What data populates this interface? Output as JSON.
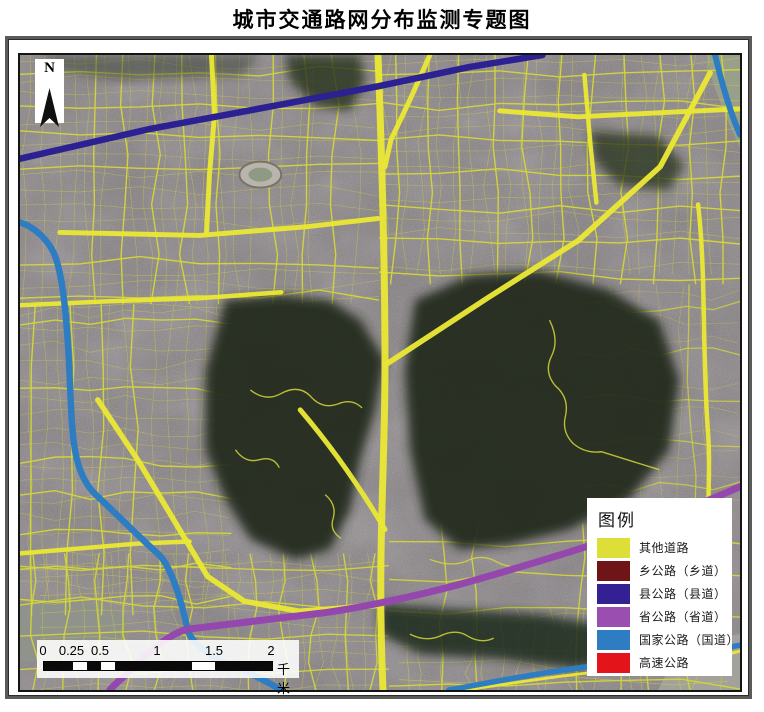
{
  "title": "城市交通路网分布监测专题图",
  "north_arrow": {
    "label": "N"
  },
  "legend": {
    "title": "图例",
    "items": [
      {
        "label": "其他道路",
        "color": "#dede39"
      },
      {
        "label": "乡公路（乡道）",
        "color": "#6f1518"
      },
      {
        "label": "县公路（县道）",
        "color": "#332193"
      },
      {
        "label": "省公路（省道）",
        "color": "#9a4fb0"
      },
      {
        "label": "国家公路（国道）",
        "color": "#2e7dc3"
      },
      {
        "label": "高速公路",
        "color": "#e3151b"
      }
    ]
  },
  "scale_bar": {
    "unit": "千米",
    "ticks": [
      {
        "f": 0,
        "t": "0"
      },
      {
        "f": 0.125,
        "t": "0.25"
      },
      {
        "f": 0.25,
        "t": "0.5"
      },
      {
        "f": 0.5,
        "t": "1"
      },
      {
        "f": 0.75,
        "t": "1.5"
      },
      {
        "f": 1,
        "t": "2"
      }
    ],
    "segments": [
      {
        "f": 0.125,
        "c": "#0a0a0a"
      },
      {
        "f": 0.0625,
        "c": "#ffffff"
      },
      {
        "f": 0.0625,
        "c": "#0a0a0a"
      },
      {
        "f": 0.0625,
        "c": "#ffffff"
      },
      {
        "f": 0.3375,
        "c": "#0a0a0a"
      },
      {
        "f": 0.1,
        "c": "#ffffff"
      },
      {
        "f": 0.25,
        "c": "#0a0a0a"
      }
    ]
  },
  "map": {
    "colors": {
      "base": "#85807d",
      "tint": "#776b85",
      "other_road": "#e9e636",
      "minor_road": "#d4d737",
      "township": "#6f1518",
      "county": "#2c2192",
      "provincial": "#9448ad",
      "national": "#2e7dc3",
      "expressway": "#e3151b"
    },
    "water": [
      {
        "fill": "#90938c",
        "d": "M0,548 L45,543 L85,551 L105,561 L111,580 L98,598 L58,601 L18,609 L0,607 Z"
      },
      {
        "fill": "#a2a19b",
        "d": "M640,637 L658,601 L688,586 L722,581 L722,637 Z"
      },
      {
        "fill": "#99a089",
        "d": "M688,0 L722,0 L722,93 L706,58 L693,22 Z"
      }
    ],
    "grid_zones": [
      {
        "x": 0,
        "y": 0,
        "w": 360,
        "h": 250,
        "sx": 30,
        "sy": 32,
        "seed": 7,
        "width": 1.4,
        "op": 0.95
      },
      {
        "x": 360,
        "y": 0,
        "w": 362,
        "h": 230,
        "sx": 33,
        "sy": 34,
        "seed": 11,
        "width": 1.4,
        "op": 0.95
      },
      {
        "x": 0,
        "y": 250,
        "w": 212,
        "h": 312,
        "sx": 33,
        "sy": 35,
        "seed": 13,
        "width": 1.4,
        "op": 0.95
      },
      {
        "x": 0,
        "y": 500,
        "w": 370,
        "h": 137,
        "sx": 31,
        "sy": 33,
        "seed": 17,
        "width": 1.4,
        "op": 0.9
      },
      {
        "x": 370,
        "y": 470,
        "w": 352,
        "h": 167,
        "sx": 35,
        "sy": 36,
        "seed": 19,
        "width": 1.4,
        "op": 0.9
      },
      {
        "x": 560,
        "y": 230,
        "w": 162,
        "h": 240,
        "sx": 45,
        "sy": 45,
        "seed": 23,
        "width": 1.3,
        "op": 0.75
      },
      {
        "x": 0,
        "y": 0,
        "w": 360,
        "h": 250,
        "sx": 15,
        "sy": 16,
        "seed": 31,
        "width": 0.6,
        "op": 0.5
      },
      {
        "x": 360,
        "y": 0,
        "w": 362,
        "h": 220,
        "sx": 17,
        "sy": 17,
        "seed": 37,
        "width": 0.6,
        "op": 0.5
      },
      {
        "x": 0,
        "y": 250,
        "w": 210,
        "h": 300,
        "sx": 16,
        "sy": 17,
        "seed": 41,
        "width": 0.6,
        "op": 0.5
      },
      {
        "x": 20,
        "y": 500,
        "w": 340,
        "h": 137,
        "sx": 16,
        "sy": 16,
        "seed": 43,
        "width": 0.6,
        "op": 0.5
      },
      {
        "x": 380,
        "y": 555,
        "w": 330,
        "h": 82,
        "sx": 16,
        "sy": 16,
        "seed": 47,
        "width": 0.7,
        "op": 0.55
      },
      {
        "x": 560,
        "y": 230,
        "w": 160,
        "h": 230,
        "sx": 23,
        "sy": 23,
        "seed": 53,
        "width": 0.6,
        "op": 0.4
      }
    ],
    "hills": [
      {
        "fill": "#222c1e",
        "op": 0.93,
        "d": "M206,246 L261,241 L311,246 L341,266 L366,306 L356,356 L341,406 L331,456 L311,496 L276,506 L231,486 L206,446 L186,396 L186,316 Z"
      },
      {
        "fill": "#202a1d",
        "op": 0.93,
        "d": "M396,246 L451,221 L521,216 L591,236 L641,266 L661,326 L651,396 L611,446 L551,476 L491,491 L441,496 L406,466 L391,396 L386,316 Z"
      },
      {
        "fill": "#26301f",
        "op": 0.8,
        "d": "M266,0 L341,0 L346,26 L331,56 L296,51 L271,26 Z"
      },
      {
        "fill": "#26301f",
        "op": 0.75,
        "d": "M571,76 L641,81 L666,111 L651,136 L601,131 L576,106 Z"
      },
      {
        "fill": "#1f2a1c",
        "op": 0.85,
        "d": "M361,551 L441,556 L521,561 L581,571 L601,601 L561,616 L481,606 L401,601 L361,581 Z"
      },
      {
        "fill": "#2b3425",
        "op": 0.45,
        "d": "M21,0 L241,0 L221,21 L101,26 L41,16 Z"
      }
    ],
    "hill_paths": [
      "M231,336 q15,12 30,4 q18,-10 30,2 q12,14 28,8 q14,-6 24,4",
      "M531,266 q10,20 2,36 q-8,16 4,30 q14,12 10,30 q-4,16 8,28 q12,10 28,8 L641,416",
      "M411,506 q20,8 36,2 q16,-8 30,0 q14,8 30,4",
      "M306,441 q12,10 8,24 q-4,12 8,20",
      "M391,581 q16,8 30,2 q16,-8 28,0 q14,8 26,2",
      "M216,396 q10,14 24,10 q14,-4 20,8"
    ],
    "stadium": {
      "cx": 241,
      "cy": 120,
      "rx": 21,
      "ry": 13
    },
    "arteries": [
      {
        "w": 7,
        "d": "M359,0 C362,80 366,200 366,311 C366,420 358,500 364,637"
      },
      {
        "w": 5,
        "d": "M411,0 L391,45 L372,85 L366,112"
      },
      {
        "w": 5.5,
        "d": "M366,311 L470,243 L560,186 L642,112 L692,18"
      },
      {
        "w": 5,
        "d": "M40,178 L180,181 L290,172 L359,164"
      },
      {
        "w": 5,
        "d": "M192,0 L195,60 L190,120 L187,179"
      },
      {
        "w": 4.5,
        "d": "M0,251 L90,247 L180,244 L262,238"
      },
      {
        "w": 5.5,
        "d": "M78,346 L118,406 L148,456 L188,523 L225,548 L280,558 L362,552"
      },
      {
        "w": 5,
        "d": "M281,356 C310,390 340,432 366,476"
      },
      {
        "w": 4.5,
        "d": "M680,150 C688,220 684,300 690,380 C693,420 688,450 692,472"
      },
      {
        "w": 4.5,
        "d": "M566,20 L572,90 L578,148"
      },
      {
        "w": 5,
        "d": "M481,56 L560,62 L640,58 L722,54"
      },
      {
        "w": 4.5,
        "d": "M0,500 L60,495 L120,490 L170,488"
      },
      {
        "w": 4,
        "d": "M612,470 C600,510 596,544 600,580"
      },
      {
        "w": 3,
        "d": "M446,637 C496,630 556,620 610,616 C660,613 700,604 722,598"
      }
    ],
    "major_roads": [
      {
        "name": "county-road",
        "color_ref": "county",
        "w": 6.5,
        "d": "M0,104 L131,74 L271,48 L361,31 L451,12 L524,0"
      },
      {
        "name": "national-road-west",
        "color_ref": "national",
        "w": 6.5,
        "d": "M0,168 C14,172 30,186 36,204 C44,228 47,270 49,306 C51,344 51,368 54,389 C57,412 64,430 76,441 C92,456 122,486 140,502 C152,514 163,552 168,576 C172,592 196,606 214,613 C232,620 250,630 262,637"
      },
      {
        "name": "national-road-northeast",
        "color_ref": "national",
        "w": 6,
        "d": "M697,0 C703,25 711,55 722,80"
      },
      {
        "name": "national-road-southeast",
        "color_ref": "national",
        "w": 5.5,
        "d": "M430,637 C480,628 540,616 600,610 C650,607 692,598 722,592"
      },
      {
        "name": "provincial-road",
        "color_ref": "provincial",
        "w": 7,
        "d": "M722,433 C690,447 640,468 601,482 C550,500 480,520 441,531 C400,542 340,555 301,560 C260,565 200,572 168,576 C150,580 128,600 112,616 C103,625 96,630 90,637"
      }
    ]
  }
}
